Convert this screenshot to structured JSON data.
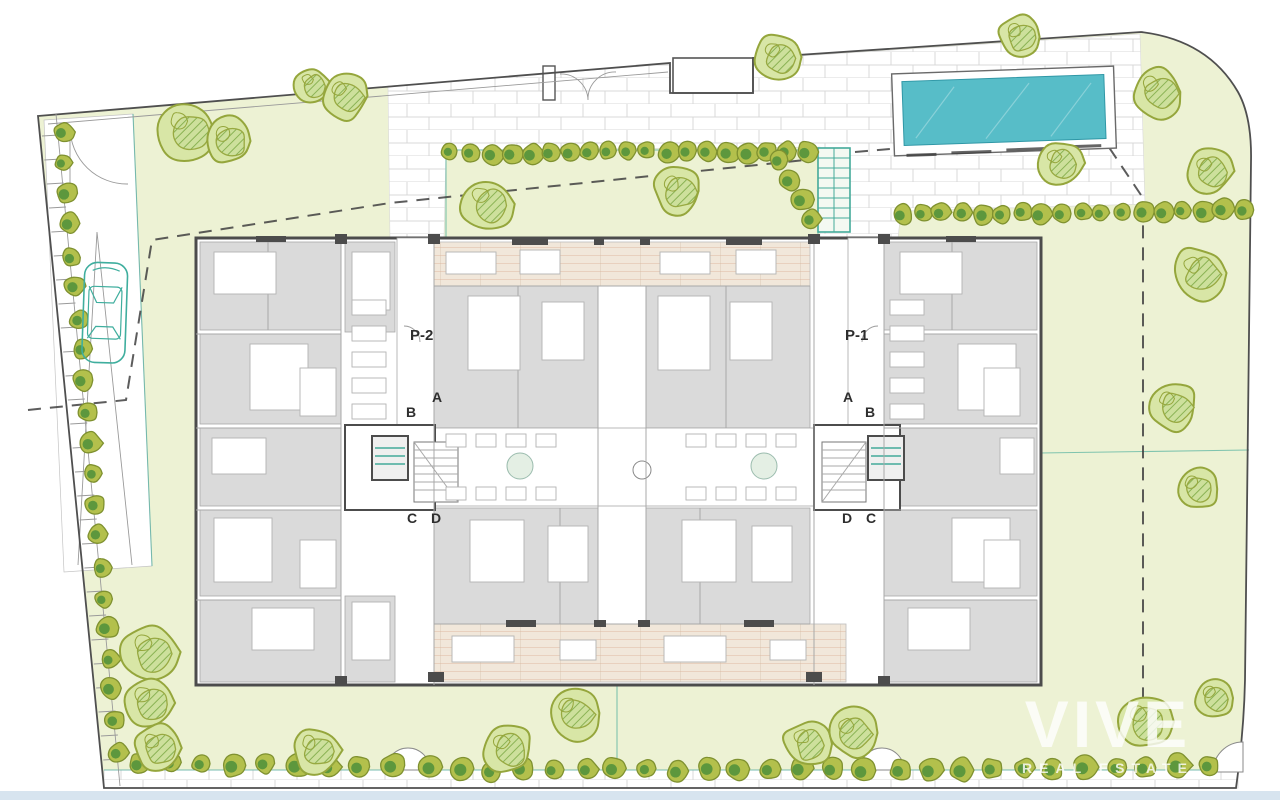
{
  "plan": {
    "type": "residential-site-plan",
    "labels": {
      "portal_left": "P-2",
      "portal_right": "P-1",
      "left": {
        "a": "A",
        "b": "B",
        "c": "C",
        "d": "D"
      },
      "right": {
        "a": "A",
        "b": "B",
        "c": "C",
        "d": "D"
      }
    },
    "watermark": {
      "brand": "VIVE",
      "tagline": "REAL ESTATE"
    }
  },
  "colors": {
    "lawn": "#edf2d4",
    "paverLine": "#d9d9d9",
    "boundary": "#4f4f4f",
    "dashed": "#3f3f3f",
    "pool": "#57bdc8",
    "poolEdge": "#2f97a6",
    "wall": "#4c4c4c",
    "room": "#dadada",
    "roomLine": "#a8a8a8",
    "deck": "#f1e7da",
    "deckLine": "#d8ab8e",
    "treeFill": "#d8e6a6",
    "treeStroke": "#95a63c",
    "treeHatch": "#86b050",
    "treeHatchBg": "#cde09c",
    "hedgeFill": "#b3c04c",
    "hedgeStroke": "#7f9130",
    "hedgeInner": "#53923c",
    "accent": "#44aa9a",
    "car": "#3fae9e",
    "watermark": "#ffffff",
    "bottomStrip": "#d7e4ef",
    "text": "#2e2e2e"
  },
  "landscape": {
    "large_trees": [
      [
        186,
        130,
        30
      ],
      [
        229,
        141,
        24
      ],
      [
        312,
        85,
        18
      ],
      [
        345,
        96,
        24
      ],
      [
        487,
        204,
        28
      ],
      [
        678,
        191,
        25
      ],
      [
        778,
        57,
        24
      ],
      [
        1020,
        37,
        22
      ],
      [
        1060,
        163,
        22
      ],
      [
        1157,
        92,
        26
      ],
      [
        1210,
        171,
        23
      ],
      [
        1199,
        273,
        27
      ],
      [
        1173,
        406,
        25
      ],
      [
        1197,
        489,
        22
      ],
      [
        1145,
        722,
        27
      ],
      [
        1214,
        698,
        20
      ],
      [
        150,
        652,
        30
      ],
      [
        149,
        703,
        27
      ],
      [
        158,
        748,
        24
      ],
      [
        315,
        750,
        24
      ],
      [
        508,
        749,
        25
      ],
      [
        573,
        713,
        27
      ],
      [
        808,
        744,
        25
      ],
      [
        853,
        733,
        25
      ]
    ],
    "hedge_rows": [
      {
        "x1": 452,
        "y1": 153,
        "x2": 806,
        "y2": 151,
        "n": 19,
        "r": 10
      },
      {
        "x1": 780,
        "y1": 160,
        "x2": 812,
        "y2": 218,
        "n": 4,
        "r": 10
      },
      {
        "x1": 902,
        "y1": 215,
        "x2": 1243,
        "y2": 210,
        "n": 18,
        "r": 10
      },
      {
        "x1": 62,
        "y1": 132,
        "x2": 118,
        "y2": 752,
        "n": 21,
        "r": 10
      },
      {
        "x1": 140,
        "y1": 764,
        "x2": 392,
        "y2": 766,
        "n": 9,
        "r": 11
      },
      {
        "x1": 432,
        "y1": 769,
        "x2": 862,
        "y2": 770,
        "n": 15,
        "r": 11
      },
      {
        "x1": 900,
        "y1": 770,
        "x2": 1208,
        "y2": 766,
        "n": 11,
        "r": 11
      }
    ]
  },
  "pool": {
    "x": 893,
    "y": 70,
    "w": 222,
    "h": 82,
    "rotation": -2
  },
  "building": {
    "furniture": [
      [
        214,
        252,
        62,
        42
      ],
      [
        250,
        344,
        58,
        66
      ],
      [
        212,
        438,
        54,
        36
      ],
      [
        214,
        518,
        58,
        64
      ],
      [
        252,
        608,
        62,
        42
      ],
      [
        352,
        252,
        38,
        58
      ],
      [
        352,
        602,
        38,
        58
      ],
      [
        446,
        252,
        50,
        22
      ],
      [
        520,
        250,
        40,
        24
      ],
      [
        660,
        252,
        50,
        22
      ],
      [
        736,
        250,
        40,
        24
      ],
      [
        468,
        296,
        52,
        74
      ],
      [
        542,
        302,
        42,
        58
      ],
      [
        658,
        296,
        52,
        74
      ],
      [
        730,
        302,
        42,
        58
      ],
      [
        470,
        520,
        54,
        62
      ],
      [
        548,
        526,
        40,
        56
      ],
      [
        682,
        520,
        54,
        62
      ],
      [
        752,
        526,
        40,
        56
      ],
      [
        452,
        636,
        62,
        26
      ],
      [
        560,
        640,
        36,
        20
      ],
      [
        664,
        636,
        62,
        26
      ],
      [
        770,
        640,
        36,
        20
      ],
      [
        900,
        252,
        62,
        42
      ],
      [
        958,
        344,
        58,
        66
      ],
      [
        1000,
        438,
        34,
        36
      ],
      [
        952,
        518,
        58,
        64
      ],
      [
        908,
        608,
        62,
        42
      ],
      [
        300,
        368,
        36,
        48
      ],
      [
        300,
        540,
        36,
        48
      ],
      [
        984,
        368,
        36,
        48
      ],
      [
        984,
        540,
        36,
        48
      ]
    ]
  }
}
